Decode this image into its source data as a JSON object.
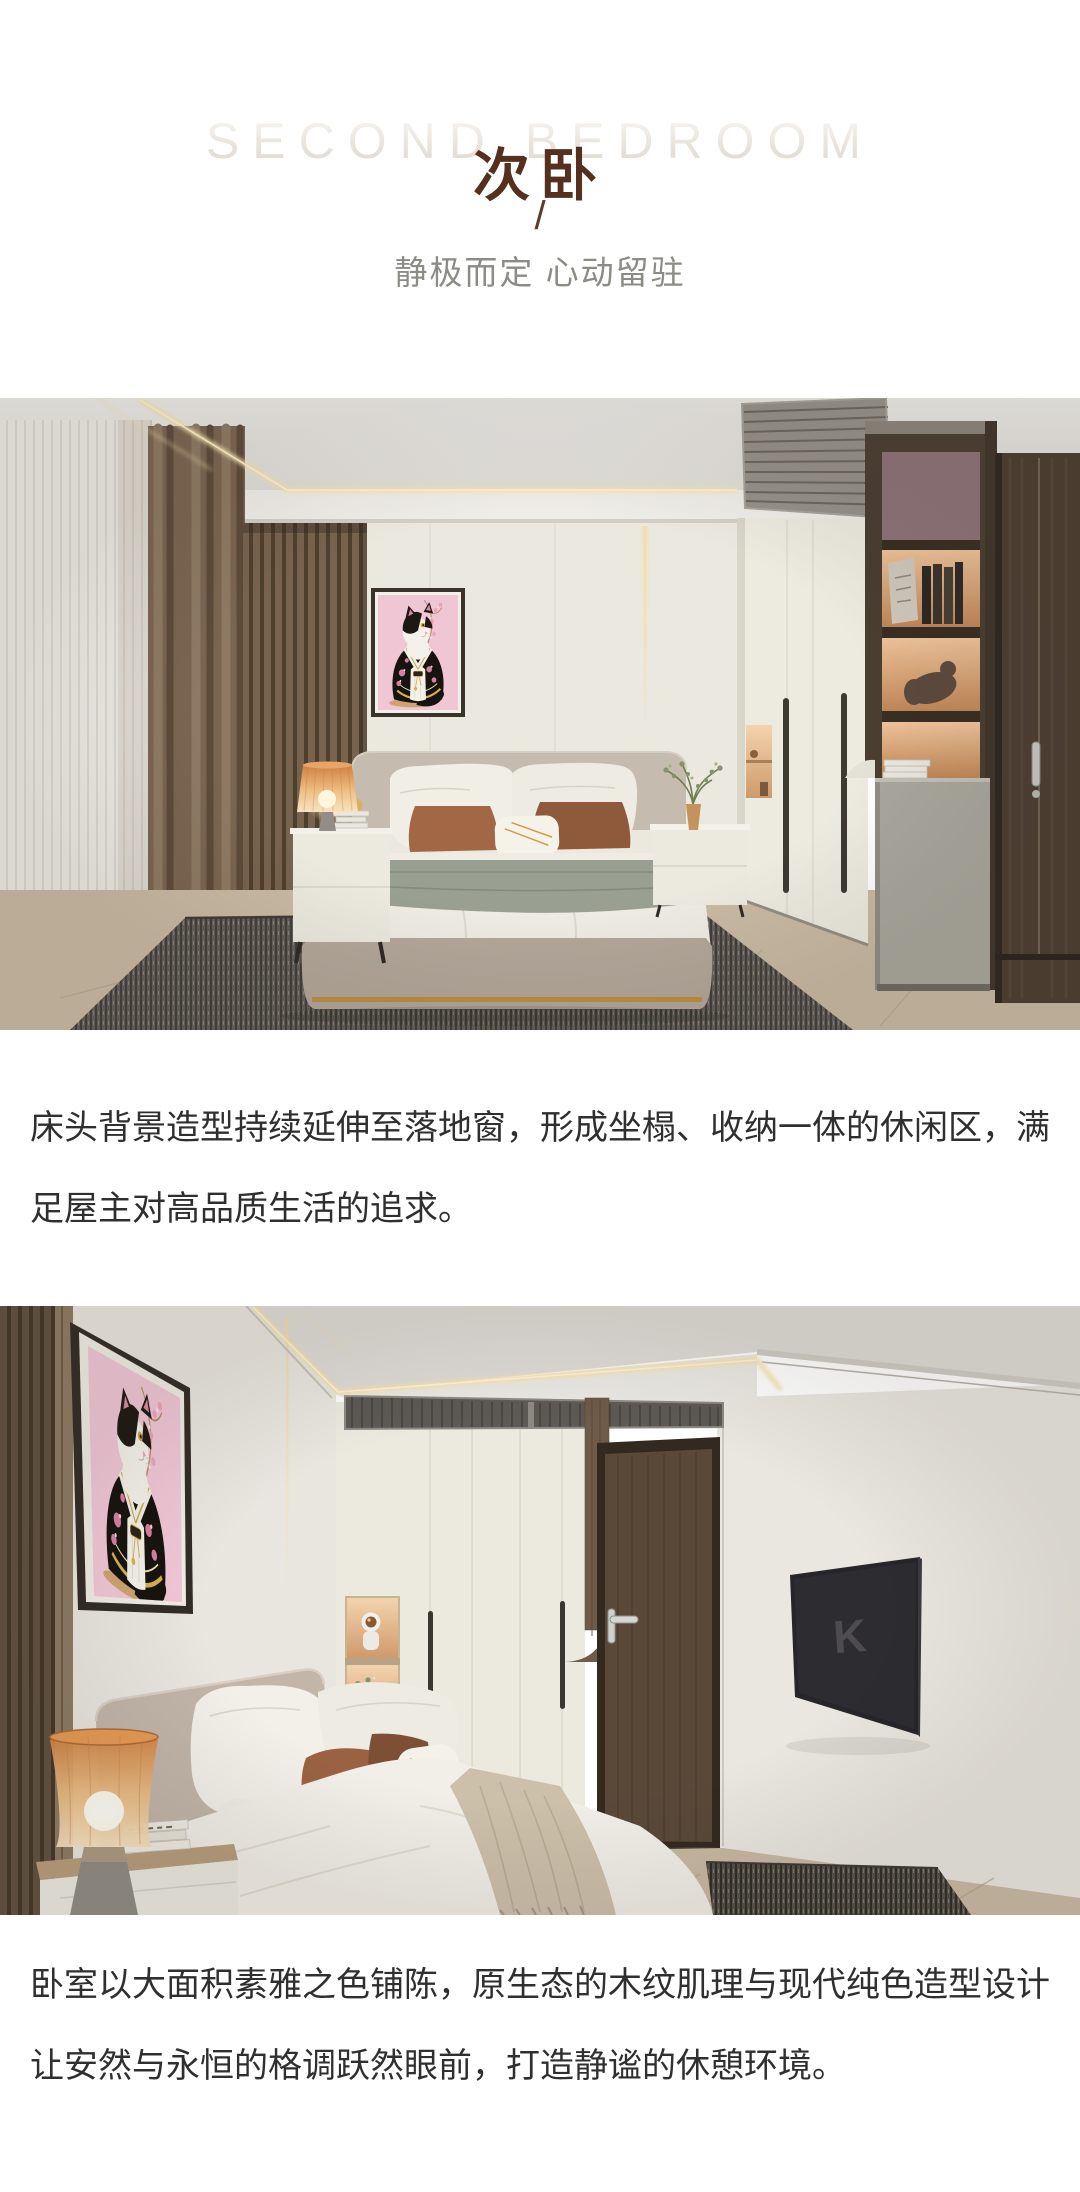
{
  "page": {
    "background": "#ffffff",
    "width": 1080,
    "height": 2192
  },
  "header": {
    "watermark": "SECOND BEDROOM",
    "title": "次卧",
    "divider": "/",
    "tagline": "静极而定 心动留驻",
    "title_color": "#55301e",
    "watermark_color": "#e7e2db",
    "tagline_color": "#8c8c86"
  },
  "intro_paragraph": {
    "lines": [
      "床头背景造型持续延伸至落地窗，形成坐榻、收纳一体的休闲区，满",
      "足屋主对高品质生活的追求。"
    ],
    "color": "#2f2f2f"
  },
  "outro_paragraph": {
    "lines": [
      "卧室以大面积素雅之色铺陈，原生态的木纹肌理与现代纯色造型设计",
      "让安然与永恒的格调跃然眼前，打造静谧的休憩环境。"
    ],
    "color": "#2f2f2f"
  },
  "render1": {
    "palette": {
      "wall": "#ebe8e0",
      "wood_slat": "#77634e",
      "led_glow": "#ffe9b4",
      "rug": "#55514a",
      "bed_base": "#b3a89a",
      "accent_pillow": "#a26845",
      "dark_wood": "#4a3e31",
      "floor": "#c9baa4"
    }
  },
  "render2": {
    "tv_logo": "K",
    "palette": {
      "wall": "#e9e6df",
      "door": "#5a4939",
      "lamp_glass": "#e0914f",
      "art_background": "#f0c6d5",
      "tv": "#26262a"
    }
  }
}
